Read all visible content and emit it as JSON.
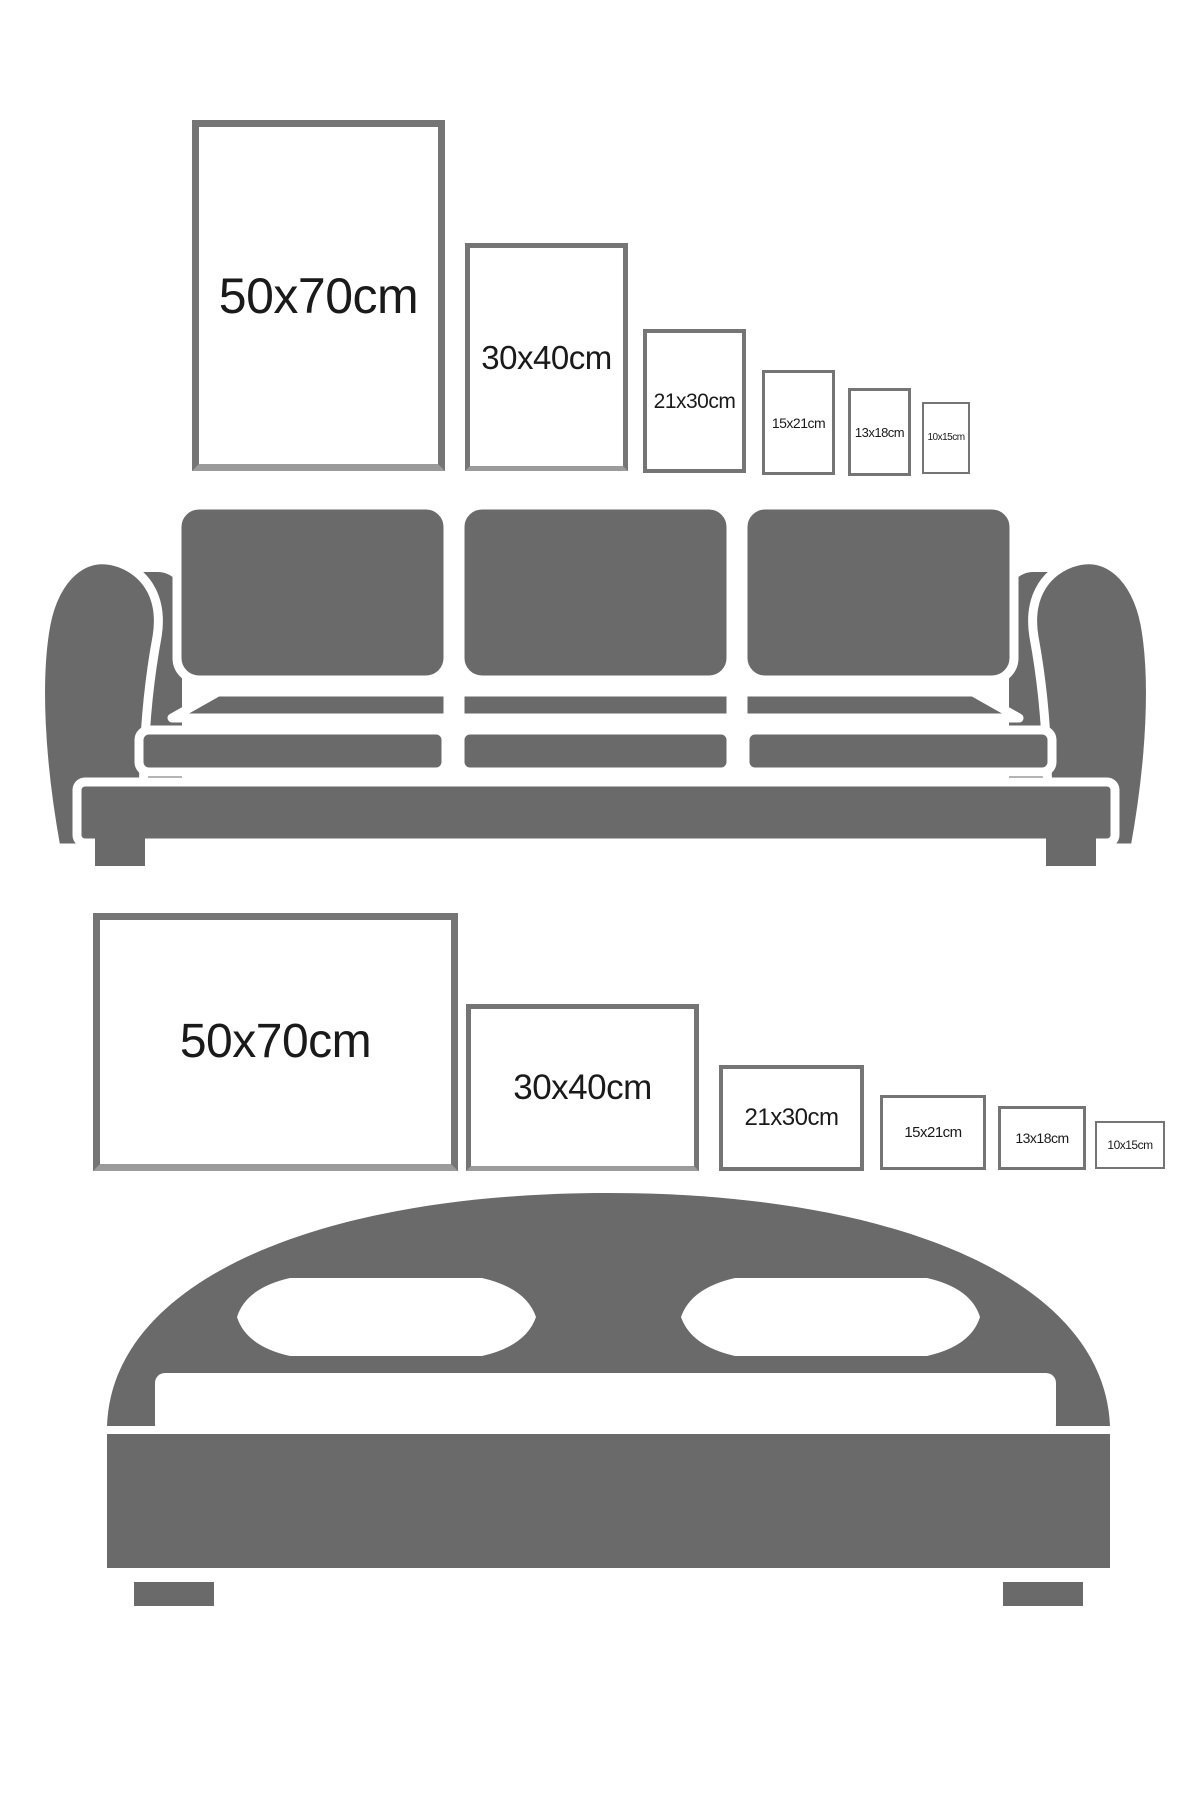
{
  "page": {
    "title": "Poster frame size comparison with furniture",
    "background": "#ffffff"
  },
  "colors": {
    "furniture_gray": "#6a6a6a",
    "frame_border": "#757575",
    "frame_fill": "#ffffff",
    "label_text": "#1a1a1a",
    "white_cutout": "#ffffff"
  },
  "sections": [
    {
      "name": "sofa-section",
      "furniture": "sofa",
      "orientation": "portrait",
      "frames": [
        {
          "label": "50x70cm",
          "x": 192,
          "y": 120,
          "w": 253,
          "h": 351,
          "border_px": 7,
          "font_px": 50
        },
        {
          "label": "30x40cm",
          "x": 465,
          "y": 243,
          "w": 163,
          "h": 228,
          "border_px": 5,
          "font_px": 33
        },
        {
          "label": "21x30cm",
          "x": 643,
          "y": 329,
          "w": 103,
          "h": 144,
          "border_px": 4,
          "font_px": 21
        },
        {
          "label": "15x21cm",
          "x": 762,
          "y": 370,
          "w": 73,
          "h": 105,
          "border_px": 3,
          "font_px": 14
        },
        {
          "label": "13x18cm",
          "x": 848,
          "y": 388,
          "w": 63,
          "h": 88,
          "border_px": 3,
          "font_px": 13
        },
        {
          "label": "10x15cm",
          "x": 922,
          "y": 402,
          "w": 48,
          "h": 72,
          "border_px": 2,
          "font_px": 10
        }
      ]
    },
    {
      "name": "bed-section",
      "furniture": "bed",
      "orientation": "landscape",
      "frames": [
        {
          "label": "50x70cm",
          "x": 93,
          "y": 913,
          "w": 365,
          "h": 258,
          "border_px": 7,
          "font_px": 48
        },
        {
          "label": "30x40cm",
          "x": 466,
          "y": 1004,
          "w": 233,
          "h": 167,
          "border_px": 5,
          "font_px": 35
        },
        {
          "label": "21x30cm",
          "x": 719,
          "y": 1065,
          "w": 145,
          "h": 106,
          "border_px": 4,
          "font_px": 24
        },
        {
          "label": "15x21cm",
          "x": 880,
          "y": 1095,
          "w": 106,
          "h": 75,
          "border_px": 3,
          "font_px": 15
        },
        {
          "label": "13x18cm",
          "x": 998,
          "y": 1106,
          "w": 88,
          "h": 64,
          "border_px": 3,
          "font_px": 14
        },
        {
          "label": "10x15cm",
          "x": 1095,
          "y": 1121,
          "w": 70,
          "h": 48,
          "border_px": 2,
          "font_px": 12
        }
      ]
    }
  ]
}
